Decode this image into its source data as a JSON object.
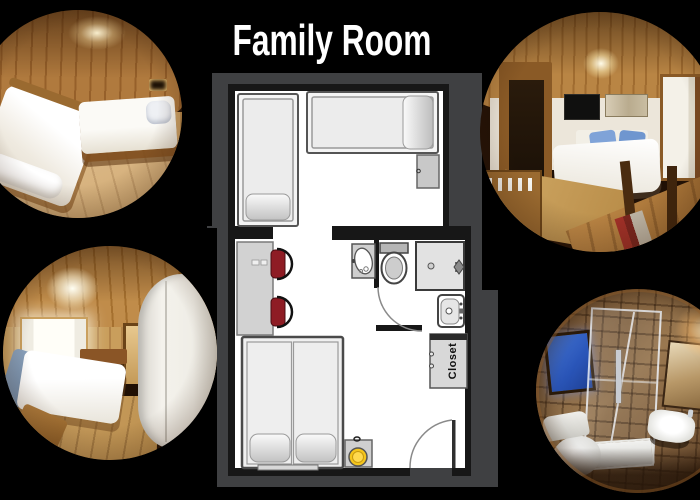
{
  "title": "Family Room",
  "plan": {
    "closet_label": "Closet",
    "colors": {
      "background": "#000000",
      "panel": "#3f4042",
      "wall": "#171717",
      "floor": "#ffffff",
      "furniture_fill": "#ededed",
      "furniture_border": "#8a8a8a",
      "chair_red": "#8e1c24",
      "lamp_yellow": "#f5c51c",
      "title_color": "#ffffff"
    },
    "fixtures": [
      "single-bed",
      "single-bed",
      "nightstand",
      "desk",
      "chair",
      "chair",
      "double-bed",
      "bedside-table-with-lamp",
      "vanity-sink",
      "toilet",
      "shower",
      "washbasin",
      "closet",
      "bathroom-door",
      "entrance-door"
    ]
  },
  "photos": {
    "top_left": "twin-bed-room-photo",
    "top_right": "double-bed-tv-room-photo",
    "bottom_left": "double-bed-window-room-photo",
    "bottom_right": "bathroom-shower-photo"
  }
}
